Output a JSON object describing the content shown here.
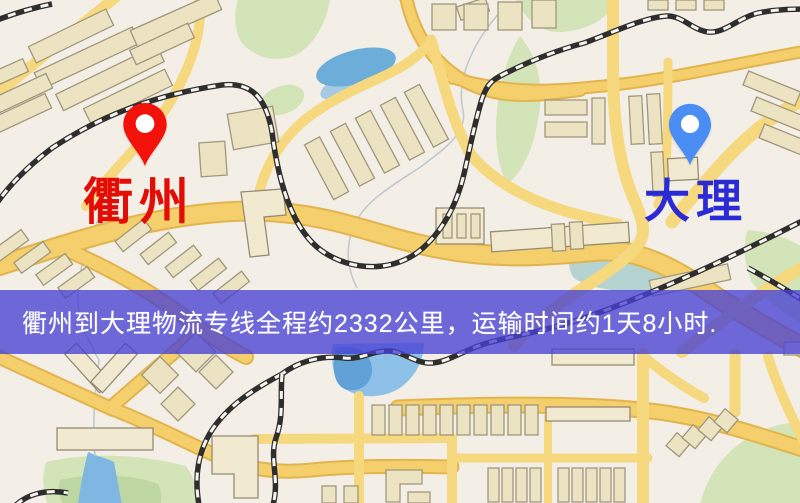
{
  "screen": {
    "width": 800,
    "height": 503
  },
  "map": {
    "kind": "street-map",
    "colors": {
      "background": "#f3efe6",
      "road_fill": "#f4cf6b",
      "road_edge": "#e2b44e",
      "building": "#ece3c2",
      "park": "#d3e4b8",
      "water": "#6cadd9",
      "railway": "#2e2e2e"
    }
  },
  "markers": {
    "origin": {
      "label": "衢州",
      "pin_color": "#f2120a",
      "pin_hole_color": "#ffffff",
      "label_color": "#e30d06"
    },
    "destination": {
      "label": "大理",
      "pin_color": "#4a8df5",
      "pin_hole_color": "#ffffff",
      "label_color": "#2b2bd5"
    }
  },
  "banner": {
    "text": "衢州到大理物流专线全程约2332公里，运输时间约1天8小时.",
    "background": "#4840d4",
    "background_opacity": "0.78",
    "text_color": "#ffffff"
  }
}
